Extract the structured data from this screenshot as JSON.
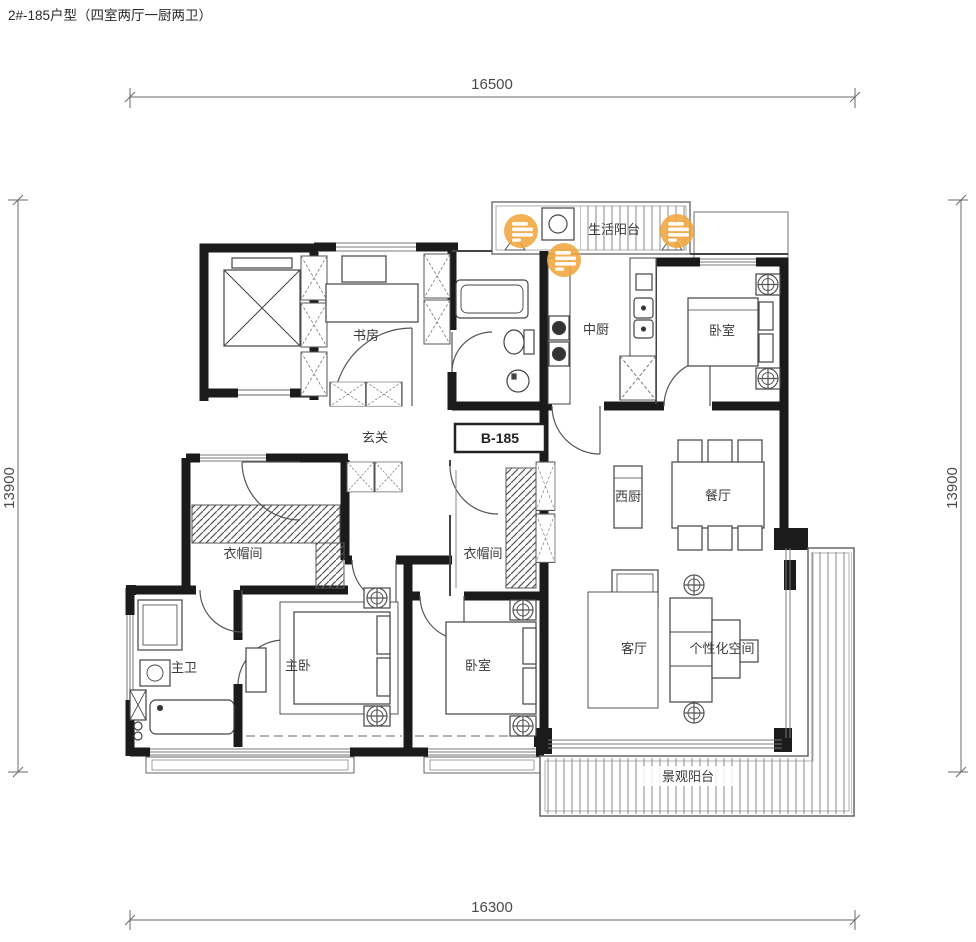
{
  "title": "2#-185户型（四室两厅一厨两卫）",
  "unit_tag": "B-185",
  "dimensions": {
    "top": "16500",
    "bottom": "16300",
    "left": "13900",
    "right": "13900"
  },
  "rooms": {
    "study": "书房",
    "entry": "玄关",
    "chinese_kitchen": "中厨",
    "bedroom_ne": "卧室",
    "service_balcony": "生活阳台",
    "west_kitchen": "西厨",
    "dining": "餐厅",
    "cloakroom_master": "衣帽间",
    "cloakroom_second": "衣帽间",
    "master_bath": "主卫",
    "master_bedroom": "主卧",
    "bedroom_s": "卧室",
    "living": "客厅",
    "flex_space": "个性化空间",
    "view_balcony": "景观阳台"
  },
  "markers": {
    "icon": "notes-icon",
    "count": 3,
    "color": "#F1A63E"
  },
  "colors": {
    "wall": "#1b1b1b",
    "line": "#555555",
    "accent": "#F1A63E",
    "text": "#3a3a3a"
  }
}
